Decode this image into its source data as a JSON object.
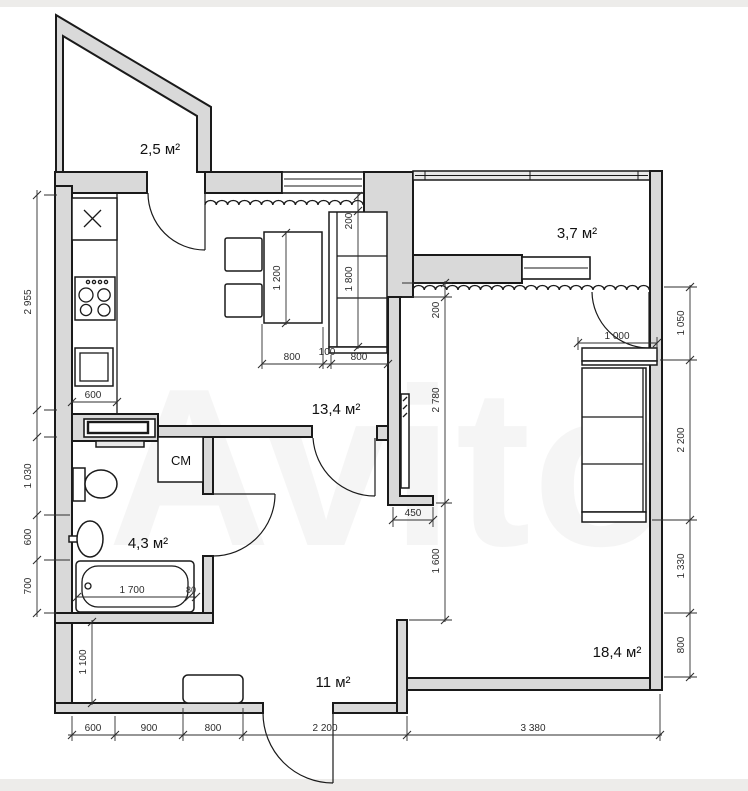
{
  "plan": {
    "watermark": "Avito",
    "colors": {
      "wall_fill": "#d9d9d9",
      "line": "#1a1a1a",
      "page_frame": "#edecea"
    },
    "rooms": {
      "balcony_small": "2,5 м²",
      "balcony_right": "3,7 м²",
      "kitchen_living": "13,4 м²",
      "bathroom": "4,3 м²",
      "hallway": "11 м²",
      "living_room": "18,4 м²",
      "washing_machine": "СМ"
    },
    "dims": {
      "left_wall": "2 955",
      "toilet_zone": "1 030",
      "basin_zone": "600",
      "tub_zone": "700",
      "kitchen_counter": "600",
      "sofa_offset": "200",
      "sofa_length": "1 800",
      "table_length": "1 200",
      "table_row_1": "800",
      "table_row_2": "100",
      "table_row_3": "800",
      "sill_offset": "200",
      "room_depth": "2 780",
      "passage": "1 600",
      "tv_wall": "450",
      "wardrobe": "1 000",
      "right_1": "1 050",
      "right_2": "2 200",
      "right_3": "1 330",
      "right_4": "800",
      "tub_length": "1 700",
      "tub_end": "80",
      "hall_depth": "1 100",
      "bottom_1": "600",
      "bottom_2": "900",
      "bottom_3": "800",
      "bottom_entry": "2 200",
      "bottom_room": "3 380"
    }
  }
}
